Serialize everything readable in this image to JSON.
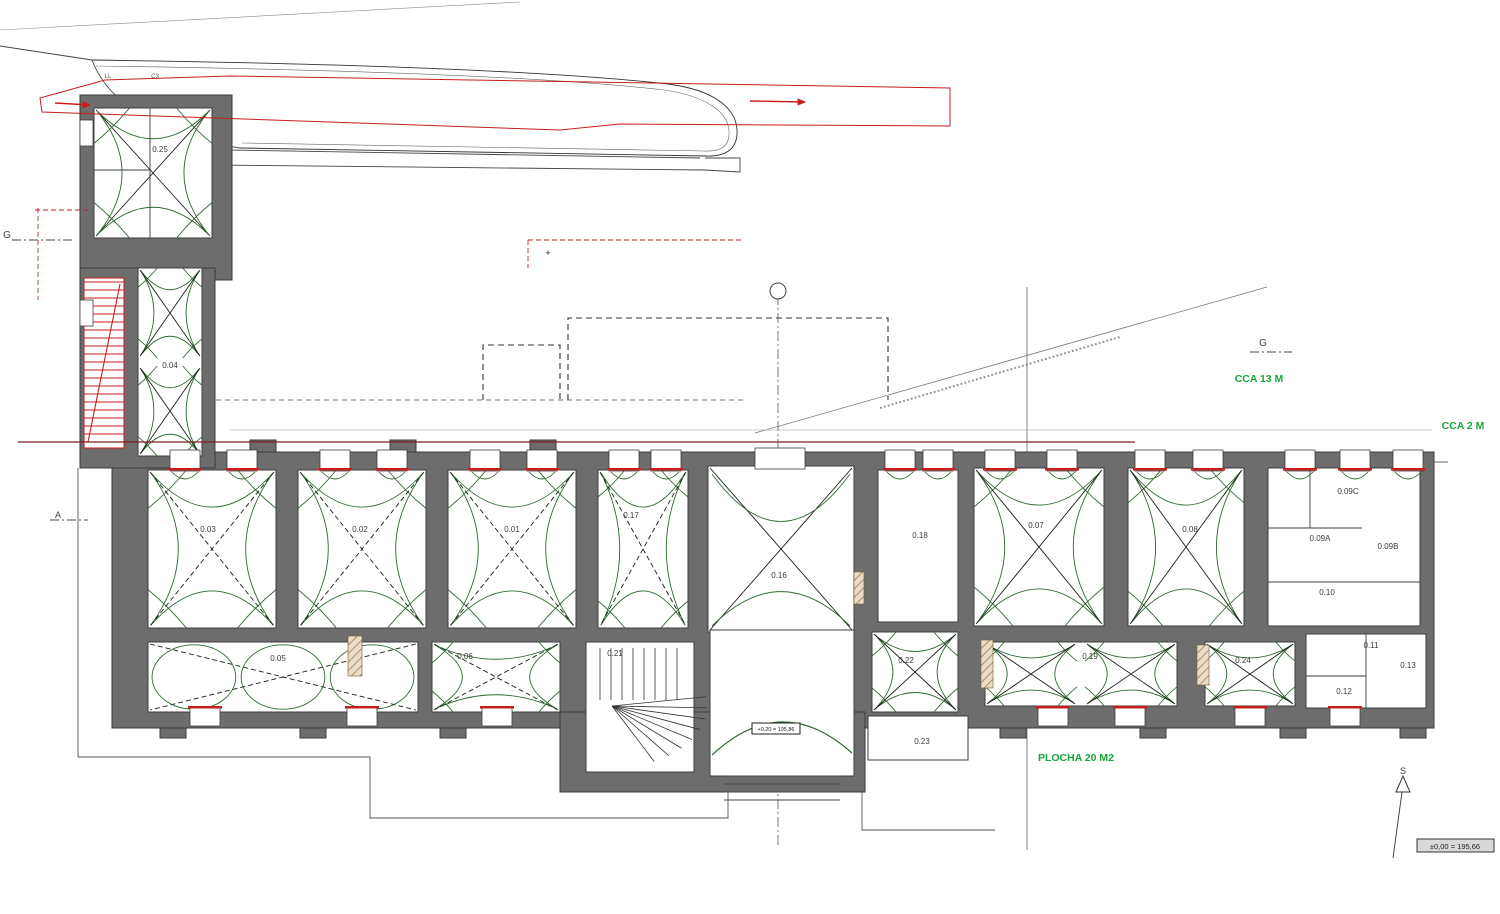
{
  "drawing": {
    "type": "architectural-floor-plan",
    "annotations": {
      "cca13": "CCA 13 M",
      "cca2": "CCA 2 M",
      "plocha": "PLOCHA 20 M2",
      "elevation_box": "±0,00 = 195,66",
      "entry_elevation": "+0,20 = 195,86",
      "north": "S",
      "section_left": "G",
      "section_right": "G",
      "section_a": "A",
      "top_note_1": "LL",
      "top_note_2": "C3"
    },
    "rooms": {
      "r25": "0.25",
      "r04": "0.04",
      "r03": "0.03",
      "r02": "0.02",
      "r01": "0.01",
      "r17": "0.17",
      "r16": "0.16",
      "r18": "0.18",
      "r07": "0.07",
      "r08": "0.08",
      "r09a": "0.09A",
      "r09b": "0.09B",
      "r09c": "0.09C",
      "r10": "0.10",
      "r05": "0.05",
      "r06": "0.06",
      "r21": "0.21",
      "r22": "0.22",
      "r23": "0.23",
      "r19": "0.19",
      "r24": "0.24",
      "r11": "0.11",
      "r12": "0.12",
      "r13": "0.13"
    },
    "marker_labels": [
      "P7",
      "D5",
      "T2",
      "P1",
      "D2",
      "D6",
      "V1",
      "D1",
      "SL",
      "C1",
      "D4",
      "P10",
      "V10",
      "D3",
      "P5",
      "61"
    ],
    "dim_labels": [
      "540",
      "95",
      "512",
      "1 970",
      "4 080",
      "745",
      "2 450",
      "1 225"
    ],
    "colors": {
      "wall": "#6d6d6d",
      "vault_green": "#2f6b2f",
      "red": "#c81e1e",
      "dark_red": "#7e1f1f",
      "highlight_green": "#17a53b",
      "purple": "#a95fc9",
      "dim": "#555555",
      "hatch": "#9c7b4f"
    }
  }
}
